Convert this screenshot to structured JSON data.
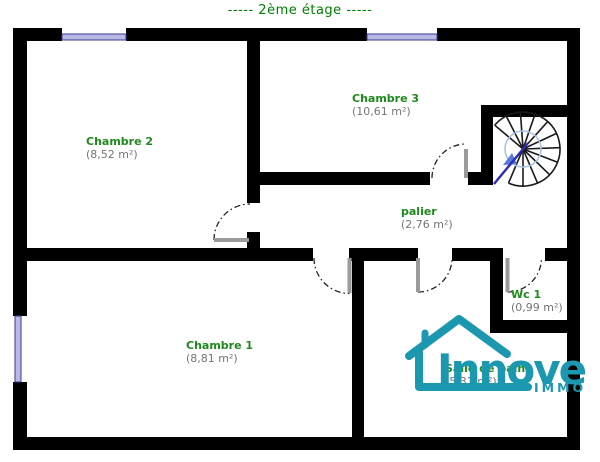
{
  "title": "-----  2ème étage  -----",
  "rooms": [
    {
      "name": "Chambre 2",
      "area": "(8,52 m²)"
    },
    {
      "name": "Chambre 3",
      "area": "(10,61 m²)"
    },
    {
      "name": "palier",
      "area": "(2,76 m²)"
    },
    {
      "name": "Chambre 1",
      "area": "(8,81 m²)"
    },
    {
      "name": "Wc 1",
      "area": "(0,99 m²)"
    },
    {
      "name": "Salle de bains",
      "area": "(5,31 m²)"
    }
  ],
  "logo": {
    "brand": "Innove",
    "sub": "IMMO"
  },
  "colors": {
    "wall": "#000000",
    "room_name_green": "#1d8a1d",
    "title_green": "#008000",
    "area_gray": "#757575",
    "window_blue": "#b9b9e8",
    "stair_arrow_blue": "#2d2db4",
    "logo_teal": "#1b98b0"
  }
}
